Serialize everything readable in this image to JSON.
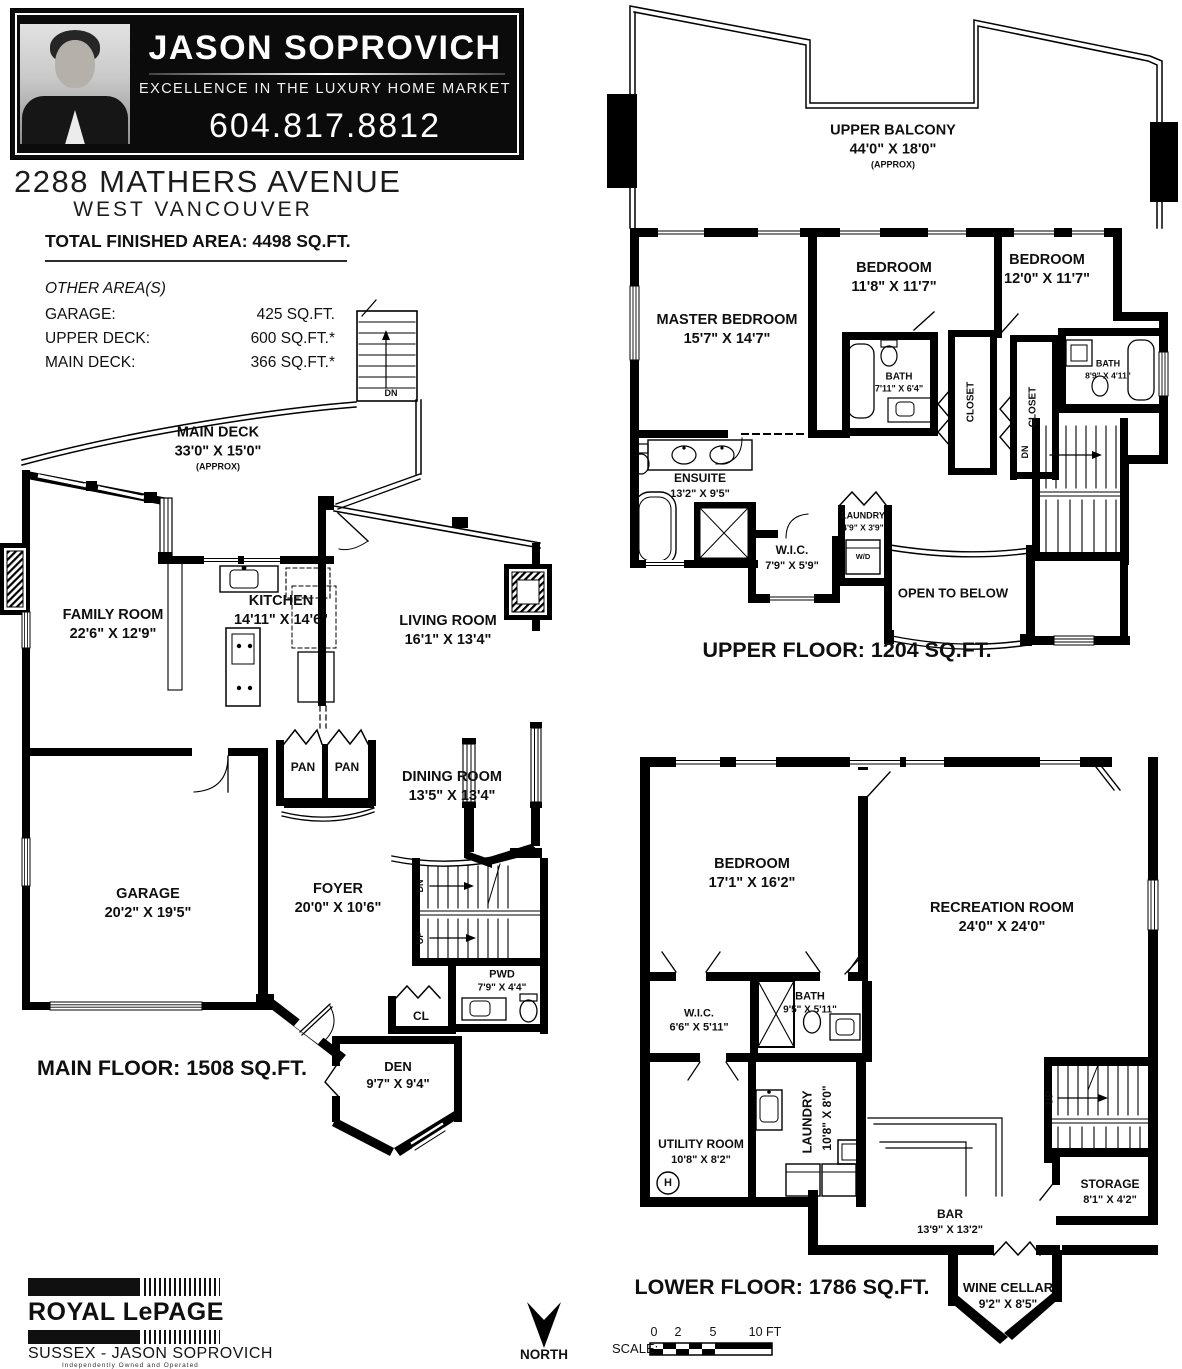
{
  "header": {
    "agent_name": "JASON SOPROVICH",
    "tagline": "EXCELLENCE IN THE LUXURY HOME MARKET",
    "phone": "604.817.8812"
  },
  "property": {
    "address": "2288 MATHERS AVENUE",
    "city": "WEST VANCOUVER",
    "total_area": "TOTAL FINISHED AREA:  4498 SQ.FT."
  },
  "other_areas": {
    "title": "OTHER AREA(S)",
    "rows": [
      {
        "label": "GARAGE:",
        "value": "425 SQ.FT."
      },
      {
        "label": "UPPER DECK:",
        "value": "600 SQ.FT.*"
      },
      {
        "label": "MAIN DECK:",
        "value": "366 SQ.FT.*"
      }
    ]
  },
  "main_floor": {
    "title": "MAIN FLOOR: 1508 SQ.FT.",
    "deck": {
      "name": "MAIN DECK",
      "dims": "33'0\" X 15'0\"",
      "approx": "(APPROX)"
    },
    "rooms": {
      "family": {
        "name": "FAMILY ROOM",
        "dims": "22'6\" X 12'9\""
      },
      "kitchen": {
        "name": "KITCHEN",
        "dims": "14'11\" X 14'6\""
      },
      "living": {
        "name": "LIVING ROOM",
        "dims": "16'1\" X 13'4\""
      },
      "dining": {
        "name": "DINING ROOM",
        "dims": "13'5\" X 13'4\""
      },
      "garage": {
        "name": "GARAGE",
        "dims": "20'2\" X 19'5\""
      },
      "foyer": {
        "name": "FOYER",
        "dims": "20'0\" X 10'6\""
      },
      "pwd": {
        "name": "PWD",
        "dims": "7'9\" X 4'4\""
      },
      "den": {
        "name": "DEN",
        "dims": "9'7\" X 9'4\""
      }
    },
    "small_labels": {
      "pan1": "PAN",
      "pan2": "PAN",
      "cl": "CL",
      "dn_deck": "DN",
      "dn": "DN",
      "up": "UP"
    }
  },
  "upper_floor": {
    "title": "UPPER FLOOR: 1204 SQ.FT.",
    "balcony": {
      "name": "UPPER BALCONY",
      "dims": "44'0\" X 18'0\"",
      "approx": "(APPROX)"
    },
    "rooms": {
      "master": {
        "name": "MASTER BEDROOM",
        "dims": "15'7\" X 14'7\""
      },
      "bedroom1": {
        "name": "BEDROOM",
        "dims": "11'8\" X 11'7\""
      },
      "bedroom2": {
        "name": "BEDROOM",
        "dims": "12'0\" X 11'7\""
      },
      "bath1": {
        "name": "BATH",
        "dims": "7'11\" X 6'4\""
      },
      "bath2": {
        "name": "BATH",
        "dims": "8'9\" X 4'11\""
      },
      "ensuite": {
        "name": "ENSUITE",
        "dims": "13'2\" X 9'5\""
      },
      "wic": {
        "name": "W.I.C.",
        "dims": "7'9\" X 5'9\""
      },
      "laundry": {
        "name": "LAUNDRY",
        "dims": "4'9\" X 3'9\""
      }
    },
    "small_labels": {
      "closet1": "CLOSET",
      "closet2": "CLOSET",
      "wd": "W/D",
      "open_below": "OPEN TO BELOW",
      "dn": "DN"
    }
  },
  "lower_floor": {
    "title": "LOWER FLOOR: 1786 SQ.FT.",
    "rooms": {
      "bedroom": {
        "name": "BEDROOM",
        "dims": "17'1\" X 16'2\""
      },
      "rec": {
        "name": "RECREATION ROOM",
        "dims": "24'0\" X 24'0\""
      },
      "wic": {
        "name": "W.I.C.",
        "dims": "6'6\" X 5'11\""
      },
      "bath": {
        "name": "BATH",
        "dims": "9'5\" X 5'11\""
      },
      "utility": {
        "name": "UTILITY ROOM",
        "dims": "10'8\" X 8'2\""
      },
      "laundry": {
        "name": "LAUNDRY",
        "dims": "10'8\" X 8'0\""
      },
      "bar": {
        "name": "BAR",
        "dims": "13'9\" X 13'2\""
      },
      "storage": {
        "name": "STORAGE",
        "dims": "8'1\" X 4'2\""
      },
      "wine": {
        "name": "WINE CELLAR",
        "dims": "9'2\" X 8'5\""
      }
    },
    "small_labels": {
      "h": "H",
      "up": "UP"
    }
  },
  "footer": {
    "brand": "ROYAL LePAGE",
    "office": "SUSSEX - JASON SOPROVICH",
    "legal": "Independently Owned and Operated",
    "north": "NORTH",
    "scale_label": "SCALE:",
    "scale_ticks": [
      "0",
      "2",
      "5",
      "10 FT"
    ]
  }
}
